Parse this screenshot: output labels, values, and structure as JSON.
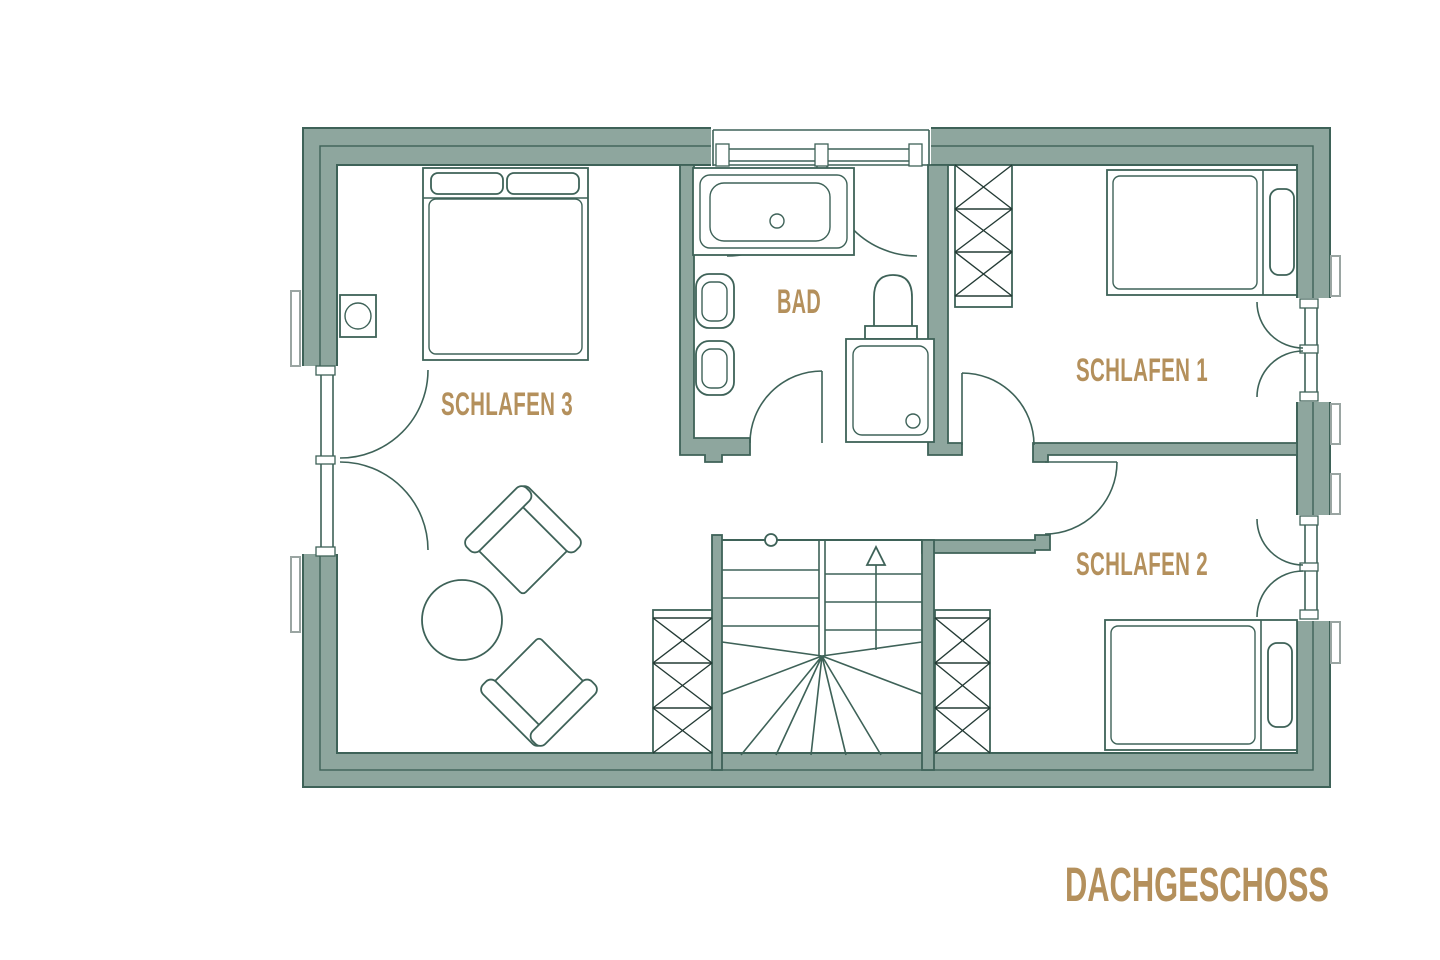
{
  "floor_plan": {
    "title": "DACHGESCHOSS",
    "rooms": [
      {
        "label": "SCHLAFEN 3"
      },
      {
        "label": "BAD"
      },
      {
        "label": "SCHLAFEN 1"
      },
      {
        "label": "SCHLAFEN 2"
      }
    ],
    "colors": {
      "wall_fill": "#8EA69E",
      "line": "#3E6258",
      "label_text": "#B4905C",
      "shutter": "#9AA5A2",
      "background": "#FFFFFF"
    }
  }
}
